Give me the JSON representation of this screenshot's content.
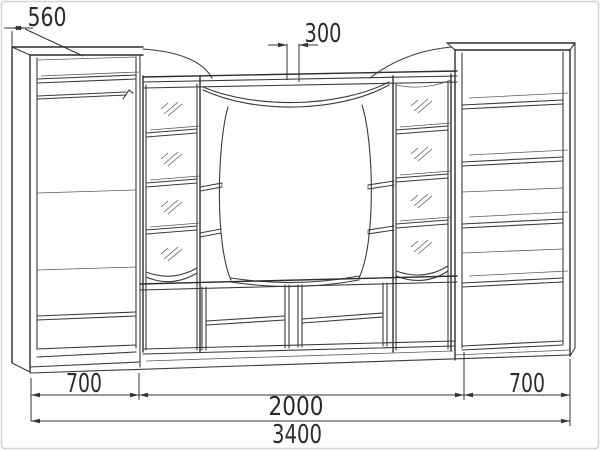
{
  "drawing": {
    "kind": "furniture-technical-drawing",
    "subject": "wall-unit wardrobe with TV niche, glass cabinets and bookshelf"
  },
  "dimensions": {
    "depth": "560",
    "top_center": "300",
    "left_width": "700",
    "center_width": "2000",
    "right_width": "700",
    "total_width": "3400"
  },
  "colors": {
    "line": "#3a3a3a",
    "background": "#ffffff",
    "border": "#d5d5d5"
  }
}
